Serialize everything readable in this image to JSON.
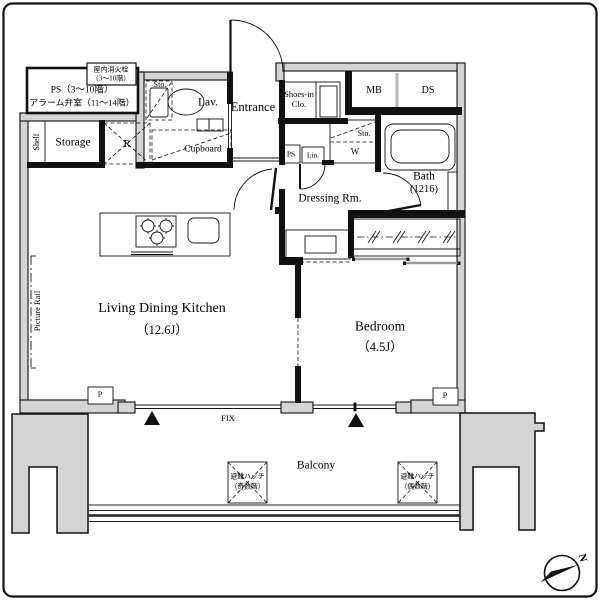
{
  "rooms": {
    "living": {
      "name": "Living Dining Kitchen",
      "size": "（12.6J）"
    },
    "bedroom": {
      "name": "Bedroom",
      "size": "（4.5J）"
    },
    "entrance": {
      "name": "Entrance"
    },
    "lavatory": {
      "name": "Lav."
    },
    "storage": {
      "name": "Storage"
    },
    "shoes_closet": {
      "line1": "Shoes-in",
      "line2": "Clo."
    },
    "dressing_room": {
      "name": "Dressing Rm."
    },
    "bath": {
      "name": "Bath",
      "size": "(1216)"
    },
    "balcony": {
      "name": "Balcony"
    }
  },
  "features": {
    "shelf": "Shelf",
    "picture_rail": "Picture Rail",
    "cupboard": "Cupboard",
    "refrigerator_space": "R",
    "meter_box": "MB",
    "duct_space": "DS",
    "pipe_shaft": "PS",
    "linen": "Lin.",
    "storage_lav": "Sto.",
    "storage_laundry": "Sto.",
    "washer": "W",
    "fix_window": "FIX",
    "pillar_left": "P",
    "pillar_right": "P"
  },
  "notes": {
    "ps_room_line1": "PS（3～10階）",
    "ps_room_line2": "アラーム弁室（11～14階）",
    "hydrant_line1": "屋内消火栓",
    "hydrant_line2": "（3～10階）",
    "hatch_odd_line1": "避難ハッチ",
    "hatch_odd_line2": "（奇数階）",
    "hatch_even_line1": "避難ハッチ",
    "hatch_even_line2": "（偶数階）"
  },
  "compass": {
    "north": "N"
  },
  "colors": {
    "wall_fill": "#d4d4d4",
    "line": "#111111",
    "background": "#ffffff"
  }
}
